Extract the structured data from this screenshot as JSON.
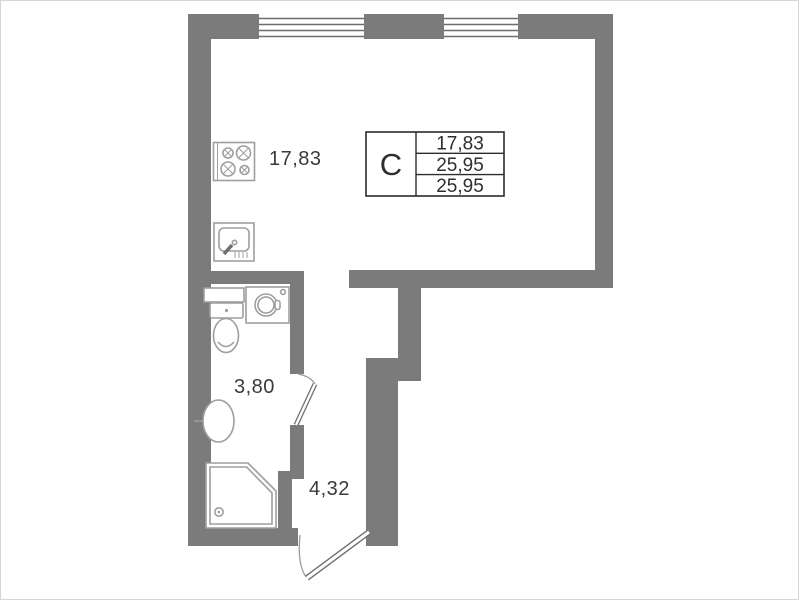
{
  "canvas": {
    "width": 799,
    "height": 600,
    "background": "#ffffff"
  },
  "colors": {
    "wall": "#7b7b7b",
    "fixture_outline": "#9e9e9e",
    "label_text": "#3a3a3a",
    "table_border": "#2b2b2b"
  },
  "rooms": {
    "main": {
      "area": "17,83"
    },
    "bathroom": {
      "area": "3,80"
    },
    "hallway": {
      "area": "4,32"
    }
  },
  "stamp": {
    "type_letter": "C",
    "rows": [
      "17,83",
      "25,95",
      "25,95"
    ]
  },
  "windows": [
    "window-1",
    "window-2"
  ],
  "doors": [
    "entrance-door",
    "bathroom-door"
  ],
  "fixtures": [
    "stove-icon",
    "kitchen-sink-icon",
    "shelf-icon",
    "washing-machine-icon",
    "toilet-icon",
    "bath-sink-icon",
    "shower-tray-icon"
  ]
}
